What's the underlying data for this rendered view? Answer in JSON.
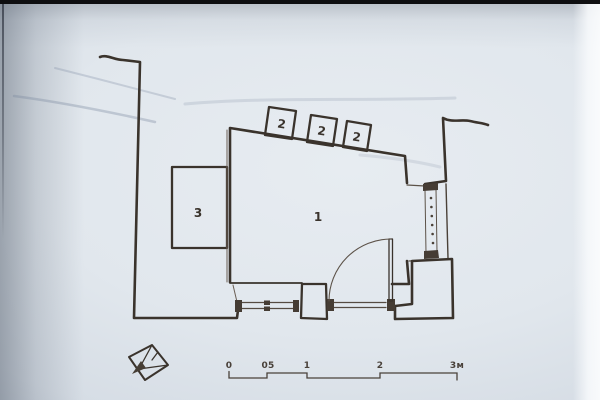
{
  "plan": {
    "rooms": [
      {
        "id": "room-1",
        "label": "1"
      },
      {
        "id": "room-3",
        "label": "3"
      }
    ],
    "annexes": [
      {
        "id": "annex-a",
        "label": "2"
      },
      {
        "id": "annex-b",
        "label": "2"
      },
      {
        "id": "annex-c",
        "label": "2"
      }
    ],
    "scale_bar": {
      "labels": [
        "0",
        "05",
        "1",
        "2",
        "3м"
      ]
    },
    "icons": {
      "north_arrow": "north-arrow-icon"
    },
    "colors": {
      "ink": "#3a332c",
      "paper": "#e1e7ed",
      "page_edge": "#0e0e10"
    }
  }
}
